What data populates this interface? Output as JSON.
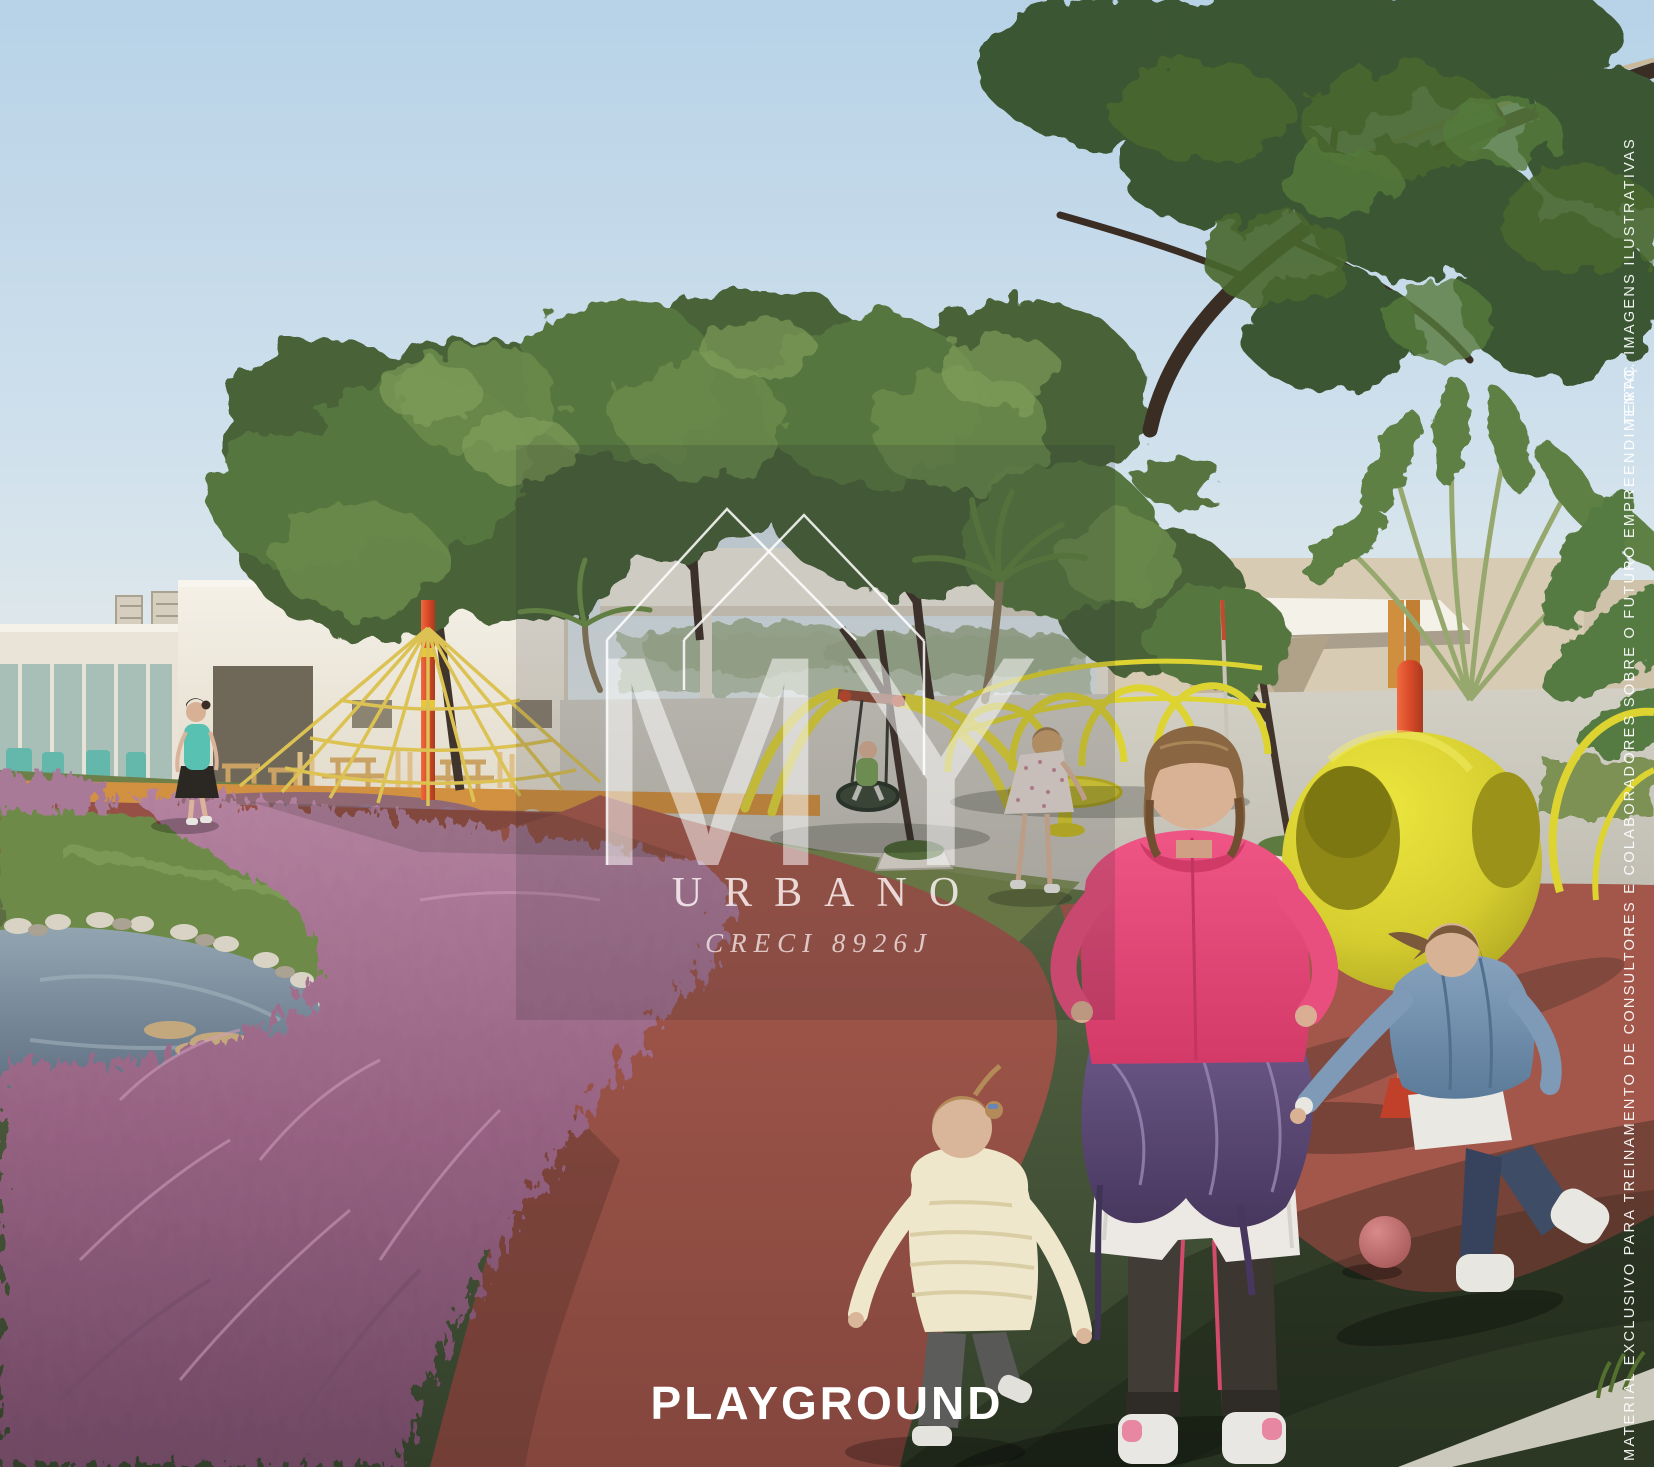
{
  "watermark": {
    "monogram": "MY",
    "brand": "URBANO",
    "license": "CRECI 8926J"
  },
  "caption": {
    "label": "PLAYGROUND"
  },
  "disclaimer": {
    "vertical_text": "MATERIAL EXCLUSIVO PARA TREINAMENTO DE CONSULTORES E COLABORADORES SOBRE O FUTURO EMPREENDIMENTO. IMAGENS ILUSTRATIVAS",
    "vertical_fragment": "TERAÇ"
  },
  "colors": {
    "sky_top": "#b7d2e7",
    "playground_yellow": "#ddd431",
    "equipment_red": "#e4532e",
    "path_red": "#a3574b",
    "rubber_green_dark": "#46553a",
    "pink_grass": "#a6749a",
    "building_white": "#efeade",
    "building_beige": "#d8cbb4",
    "caption_white": "#ffffff"
  }
}
